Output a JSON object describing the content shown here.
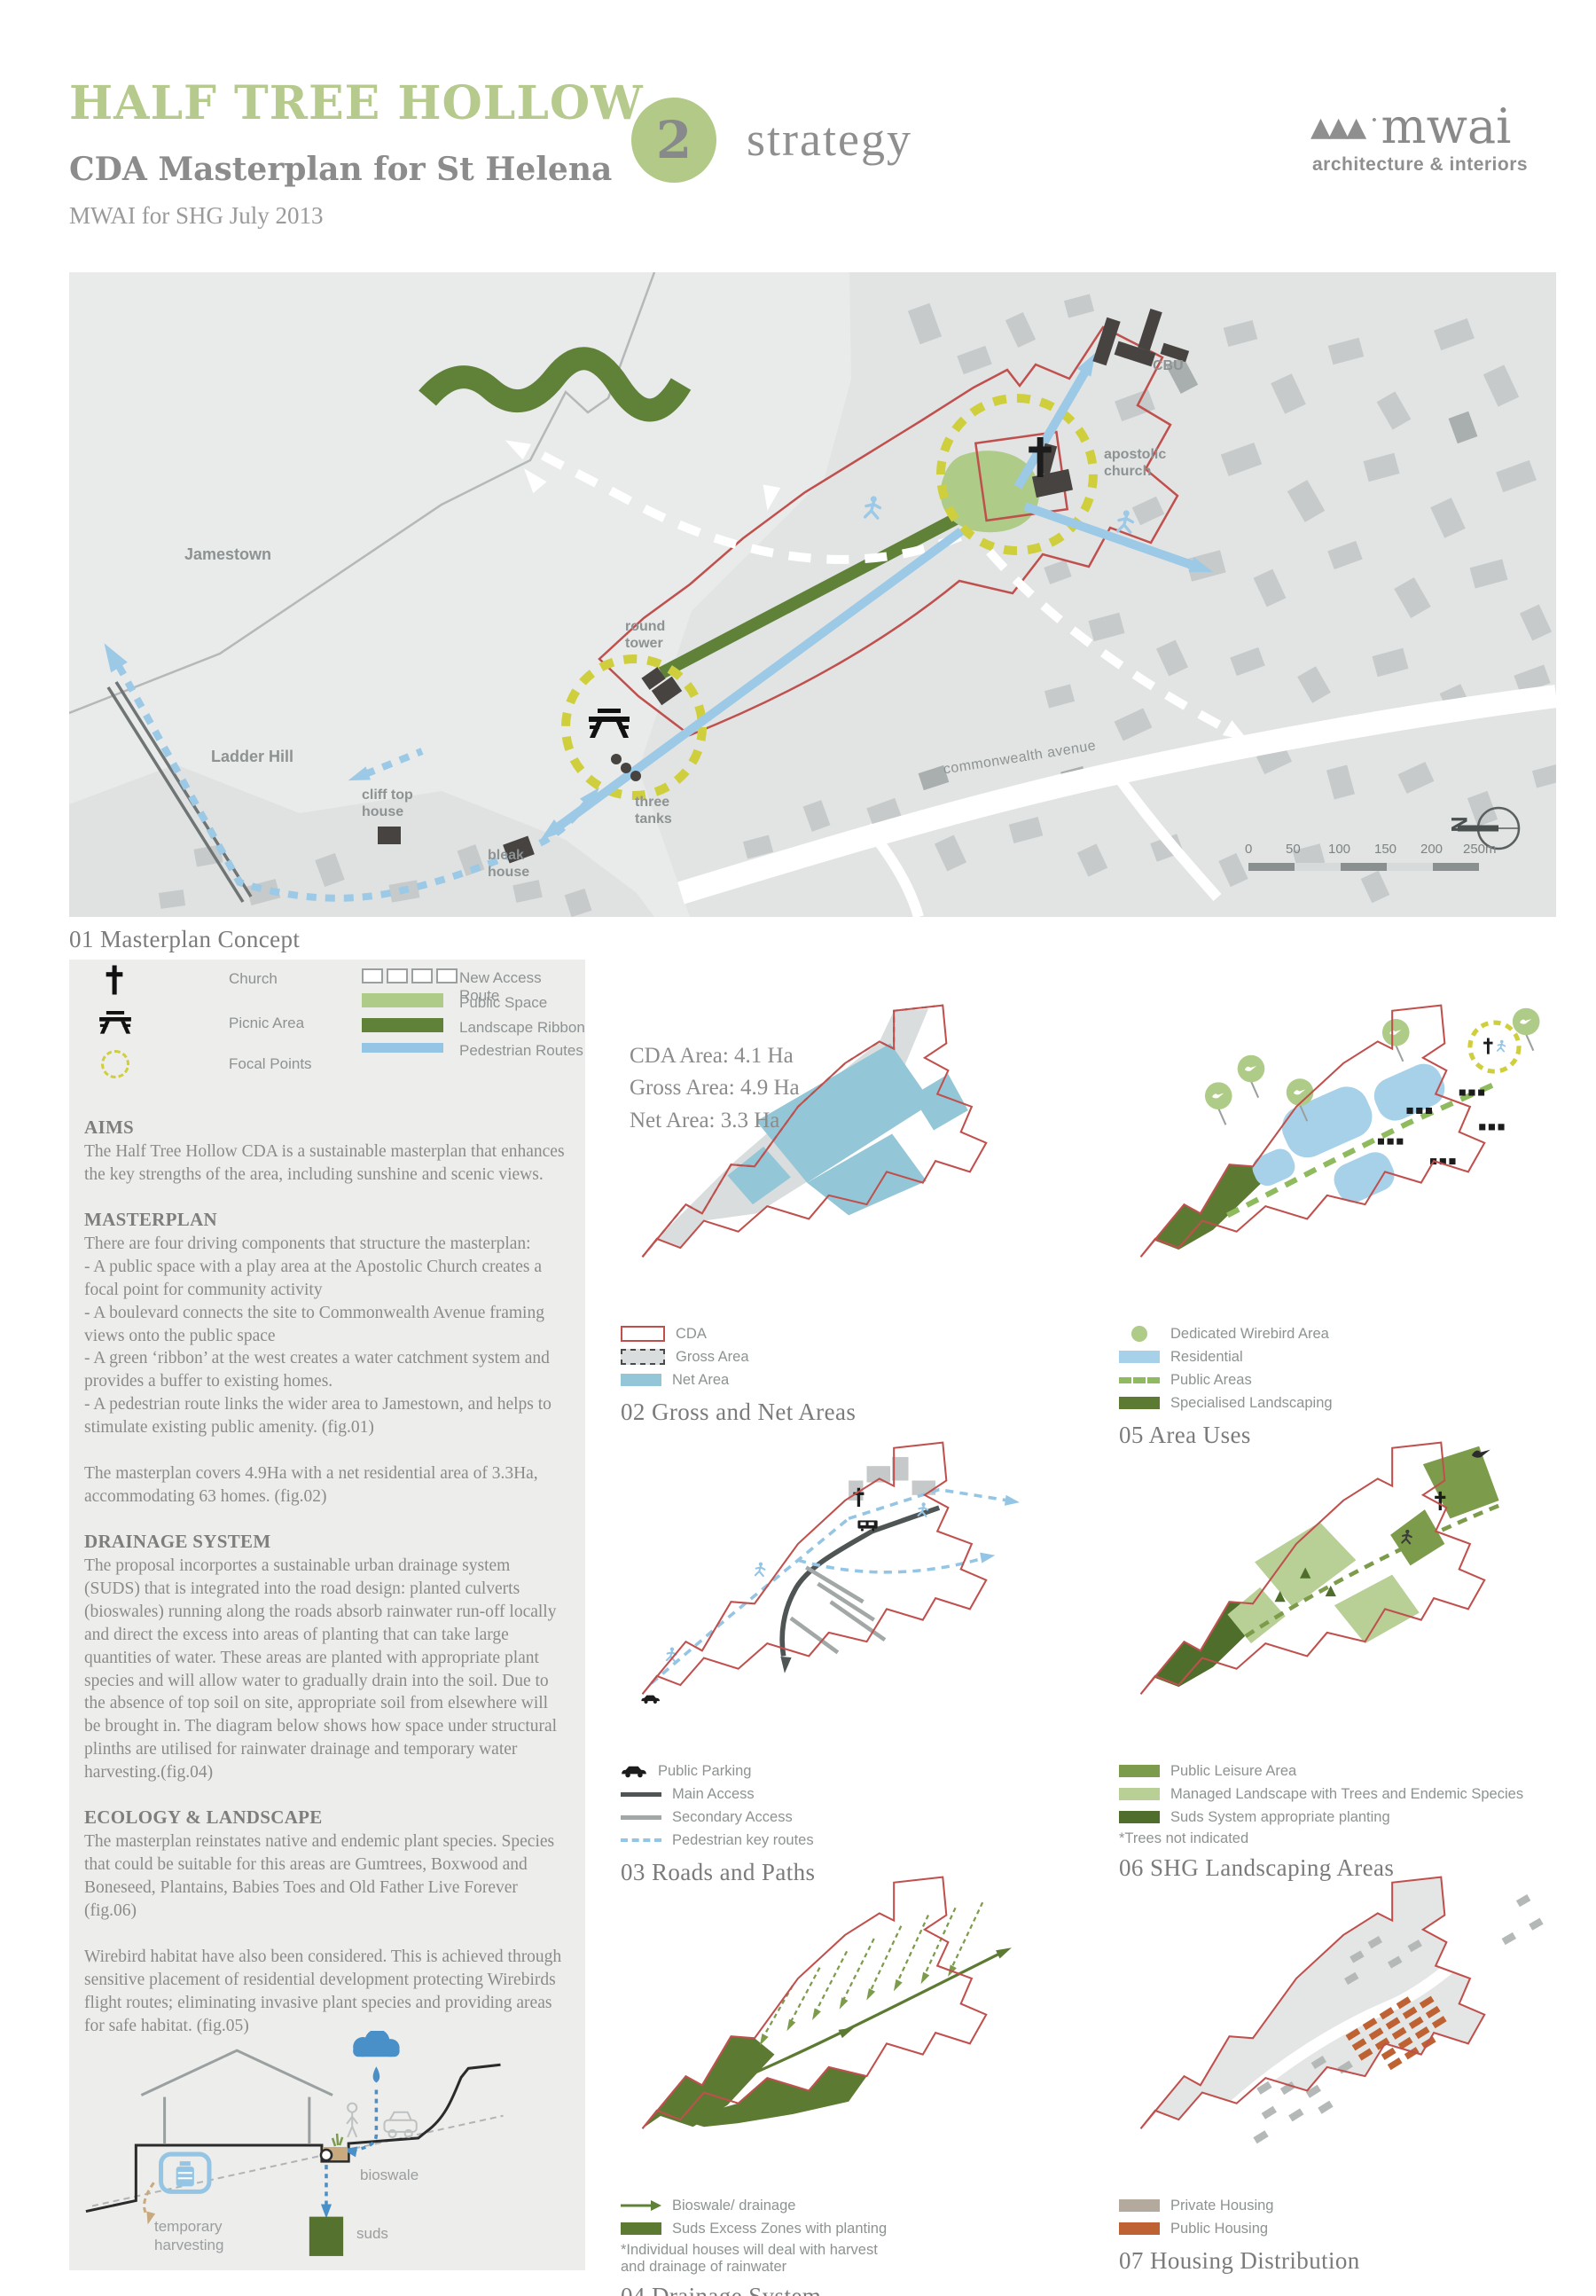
{
  "header": {
    "title": "HALF TREE HOLLOW",
    "subtitle": "CDA Masterplan for St Helena",
    "byline": "MWAI for SHG July 2013",
    "section_number": "2",
    "section_label": "strategy",
    "logo_text": "mwai",
    "logo_tagline": "architecture & interiors"
  },
  "colors": {
    "accent_green": "#b5ca8c",
    "ribbon_green": "#5f8138",
    "public_space_green": "#aecb87",
    "pedestrian_blue": "#94c5e4",
    "cda_red": "#c0504d",
    "net_area_blue": "#93c6d6",
    "residential_blue": "#a7d1e8",
    "focal_yellow": "#cfcf3e",
    "private_housing": "#b3a99c",
    "public_housing": "#bf6233"
  },
  "fig01": {
    "caption": "01 Masterplan Concept",
    "labels": {
      "jamestown": "Jamestown",
      "ladder_hill": "Ladder Hill",
      "cliff_top_house": "cliff top\nhouse",
      "bleak_house": "bleak\nhouse",
      "three_tanks": "three\ntanks",
      "round_tower": "round\ntower",
      "apostolic_church": "apostolic\nchurch",
      "cbu": "CBU",
      "commonwealth_avenue": "commonwealth avenue"
    },
    "scale_ticks": [
      "0",
      "50",
      "100",
      "150",
      "200",
      "250m"
    ],
    "north": "N"
  },
  "map_legend": {
    "church": "Church",
    "picnic": "Picnic Area",
    "focal": "Focal Points",
    "new_access": "New Access Route",
    "public_space": "Public Space",
    "landscape_ribbon": "Landscape Ribbon",
    "pedestrian": "Pedestrian Routes"
  },
  "sections": [
    {
      "heading": "AIMS",
      "body": "The Half Tree Hollow CDA is a sustainable masterplan that enhances the key strengths of the area, including sunshine and scenic views."
    },
    {
      "heading": "MASTERPLAN",
      "body": "There are four driving components that structure the masterplan:\n- A public space with a play area at the Apostolic Church creates a focal point for community activity\n- A boulevard connects the site to Commonwealth Avenue framing views onto the public space\n- A green ‘ribbon’ at the west creates a water catchment system and provides a buffer to existing homes.\n- A pedestrian route links the wider area to Jamestown, and helps to stimulate existing public amenity. (fig.01)\n\nThe masterplan covers 4.9Ha with a net residential area of 3.3Ha, accommodating 63 homes. (fig.02)"
    },
    {
      "heading": "DRAINAGE SYSTEM",
      "body": "The proposal incorportes a sustainable urban drainage system (SUDS) that is integrated into the road design: planted culverts (bioswales) running along the roads absorb rainwater run-off locally and direct the excess into areas of planting that can take large quantities of water. These areas are planted with appropriate plant species and will allow water to gradually drain into the soil. Due to the absence of top soil on site, appropriate soil from elsewhere will be brought in. The diagram below shows how space under structural plinths are utilised for rainwater drainage and temporary water harvesting.(fig.04)"
    },
    {
      "heading": "ECOLOGY & LANDSCAPE",
      "body": "The masterplan reinstates native and endemic plant species. Species that could be suitable for this areas are Gumtrees, Boxwood and Boneseed, Plantains, Babies Toes and Old Father Live Forever (fig.06)\n\nWirebird habitat have also been considered. This is achieved through sensitive placement of residential development protecting Wirebirds flight routes; eliminating invasive plant species and providing areas for safe habitat. (fig.05)"
    }
  ],
  "diagram": {
    "temporary_harvesting": "temporary\nharvesting",
    "bioswale": "bioswale",
    "suds": "suds"
  },
  "fig02": {
    "stats": [
      "CDA Area: 4.1 Ha",
      "Gross Area: 4.9 Ha",
      "Net Area: 3.3 Ha"
    ],
    "legend": [
      "CDA",
      "Gross Area",
      "Net Area"
    ],
    "caption": "02 Gross and Net Areas"
  },
  "fig03": {
    "legend": [
      "Public Parking",
      "Main Access",
      "Secondary Access",
      "Pedestrian key routes"
    ],
    "caption": "03 Roads and Paths"
  },
  "fig04": {
    "legend": [
      "Bioswale/ drainage",
      "Suds Excess Zones with planting"
    ],
    "note": "*Individual houses will deal with harvest\nand drainage of rainwater",
    "caption": "04 Drainage System"
  },
  "fig05": {
    "legend": [
      "Dedicated Wirebird Area",
      "Residential",
      "Public Areas",
      "Specialised Landscaping"
    ],
    "caption": "05 Area Uses"
  },
  "fig06": {
    "legend": [
      "Public Leisure Area",
      "Managed Landscape with Trees and Endemic Species",
      "Suds System appropriate planting"
    ],
    "note": "*Trees not indicated",
    "caption": "06 SHG Landscaping Areas"
  },
  "fig07": {
    "legend": [
      "Private Housing",
      "Public Housing"
    ],
    "caption": "07 Housing Distribution"
  }
}
